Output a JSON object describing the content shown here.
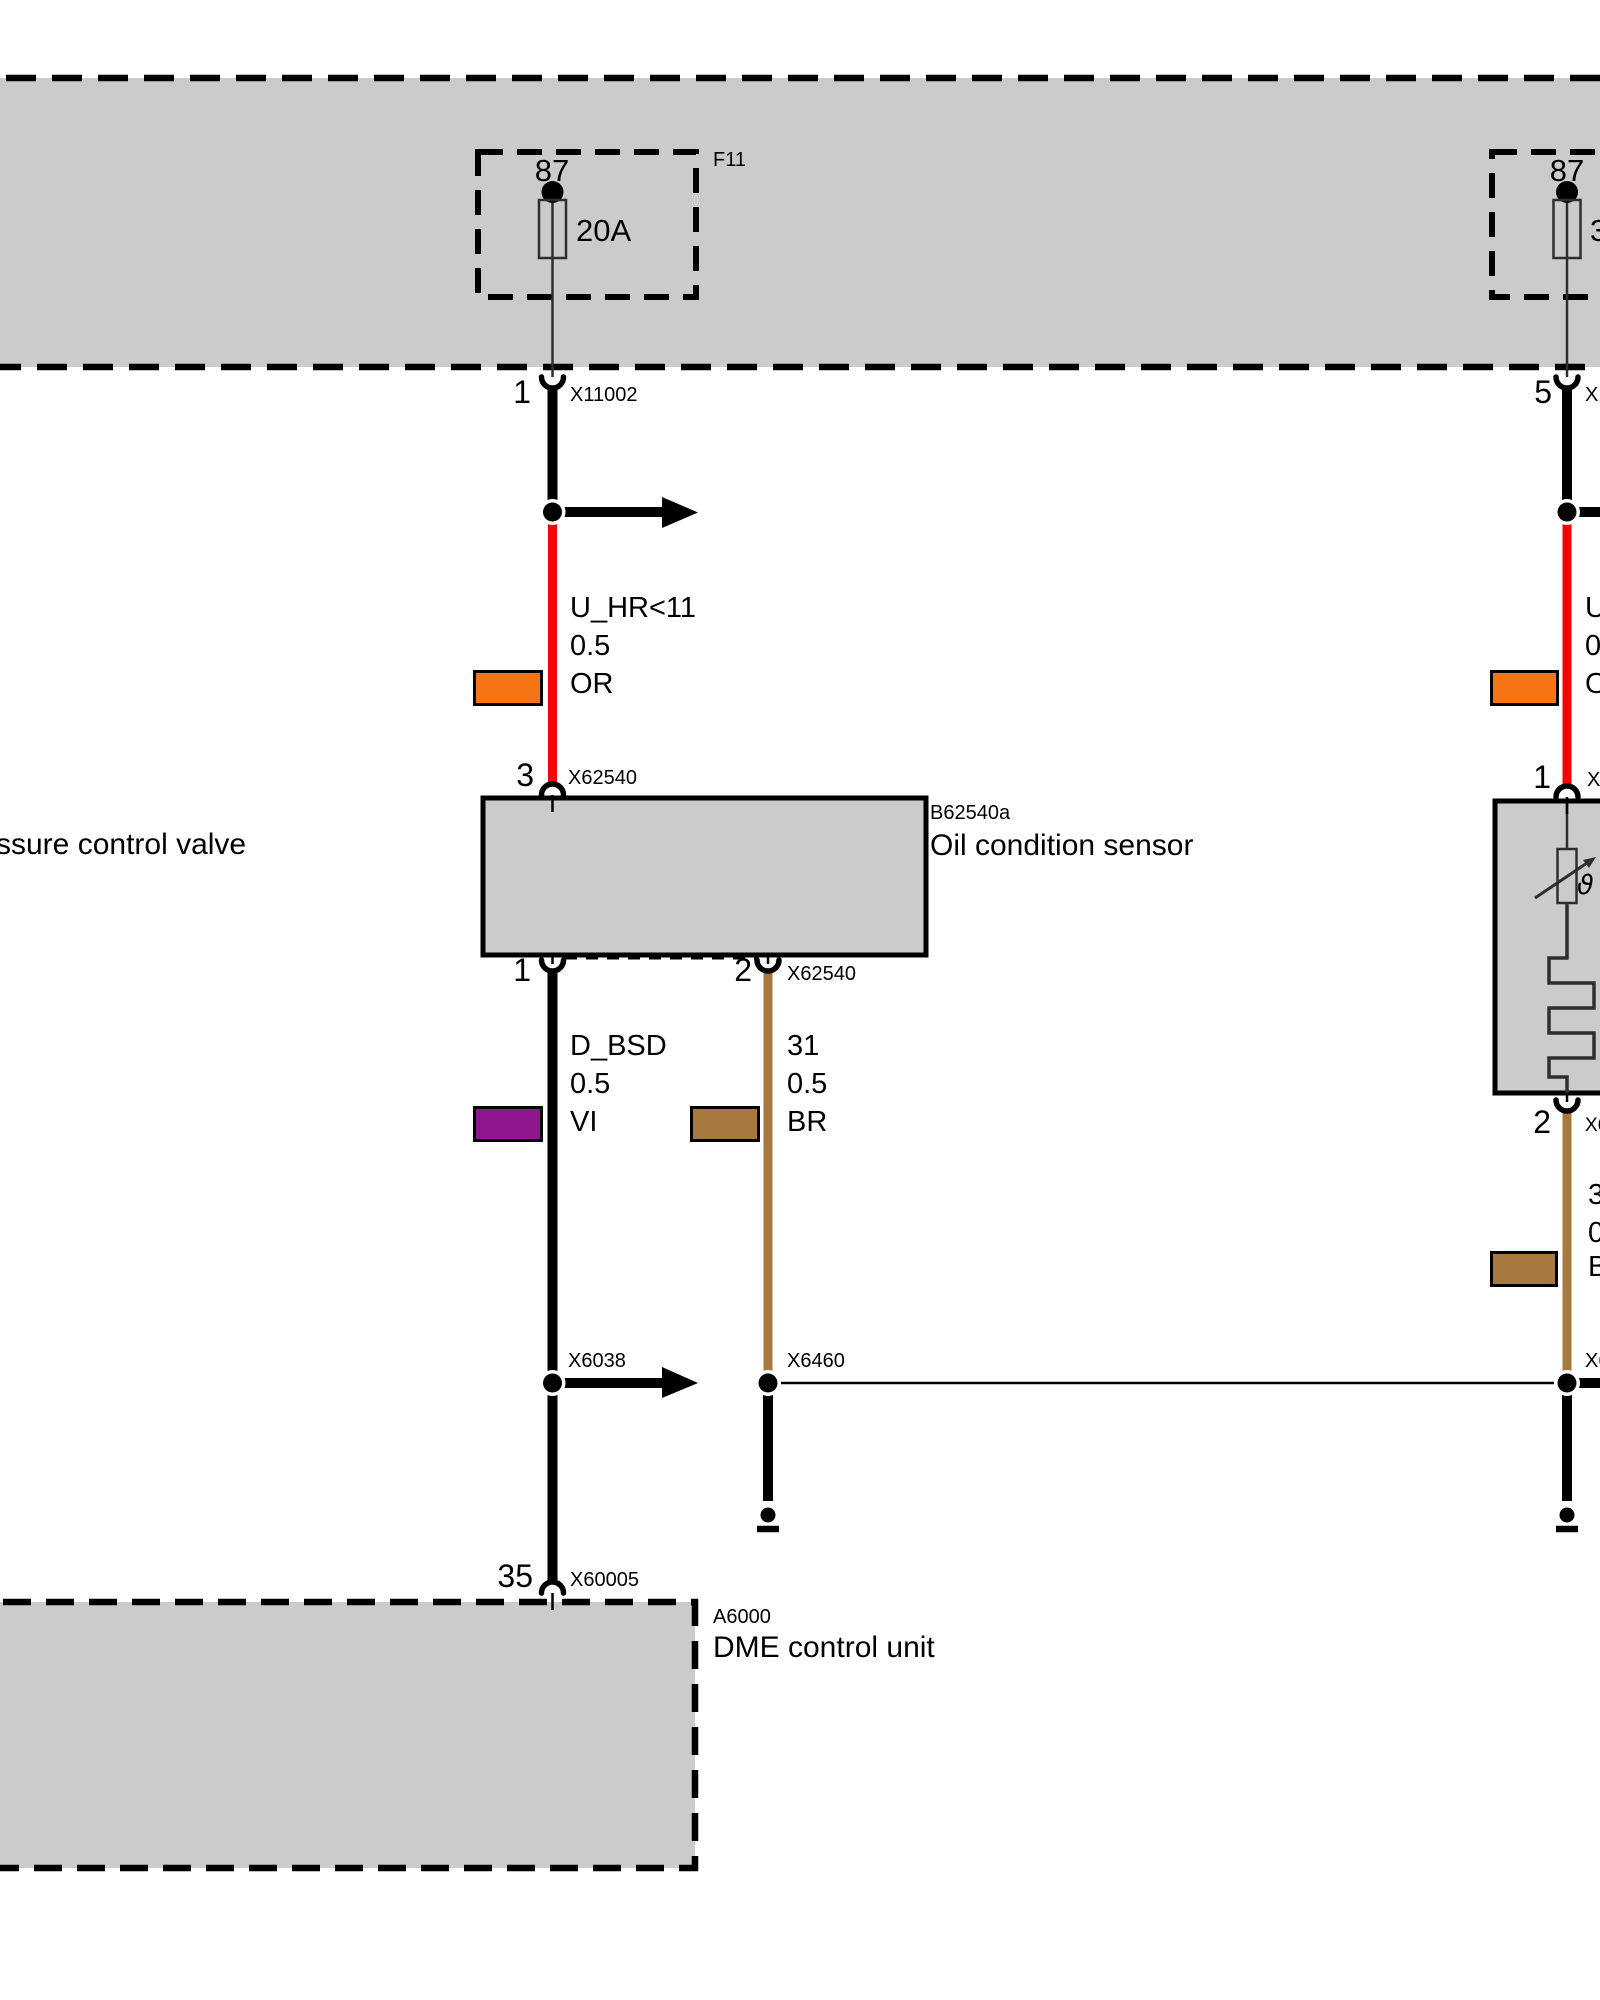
{
  "colors": {
    "panel_gray": "#cbcbcb",
    "wire_red": "#f40606",
    "wire_brown": "#a8793f",
    "swatch_orange": "#f57413",
    "swatch_violet": "#8e168e",
    "swatch_brown": "#a8793f"
  },
  "power_band": {
    "left_fuse": {
      "terminal": "87",
      "rating": "20A",
      "code": "F11"
    },
    "right_fuse": {
      "terminal": "87",
      "rating": "3"
    }
  },
  "oil_sensor_circuit": {
    "top_connector": {
      "pin": "1",
      "code": "X11002"
    },
    "supply_wire": {
      "signal": "U_HR<11",
      "cross_section": "0.5",
      "color_code": "OR"
    },
    "sensor_top_connector": {
      "pin": "3",
      "code": "X62540"
    },
    "sensor": {
      "code": "B62540a",
      "name": "Oil condition sensor"
    },
    "sensor_pin_signal": {
      "pin": "1"
    },
    "sensor_pin_ground": {
      "pin": "2",
      "code": "X62540"
    },
    "signal_wire": {
      "signal": "D_BSD",
      "cross_section": "0.5",
      "color_code": "VI"
    },
    "ground_wire": {
      "signal": "31",
      "cross_section": "0.5",
      "color_code": "BR"
    },
    "signal_junction_code": "X6038",
    "ground_junction_code": "X6460",
    "dme_connector": {
      "pin": "35",
      "code": "X60005"
    },
    "control_unit": {
      "code": "A6000",
      "name": "DME control unit"
    }
  },
  "right_circuit": {
    "top_connector_pin": "5",
    "sensor_top_pin": "1",
    "sensor_pin": "2",
    "temperature_symbol": "ϑ"
  },
  "clipped_labels": {
    "left_component": "ssure control valve",
    "right_top_connector_code": "X1",
    "right_supply_signal": "U",
    "right_supply_cross_section": "0",
    "right_supply_color": "O",
    "right_sensor_top_code": "X6",
    "right_sensor_pin_code": "X6",
    "right_ground_signal": "3",
    "right_ground_cross_section": "0",
    "right_ground_color": "B",
    "right_junction_code": "X6"
  }
}
